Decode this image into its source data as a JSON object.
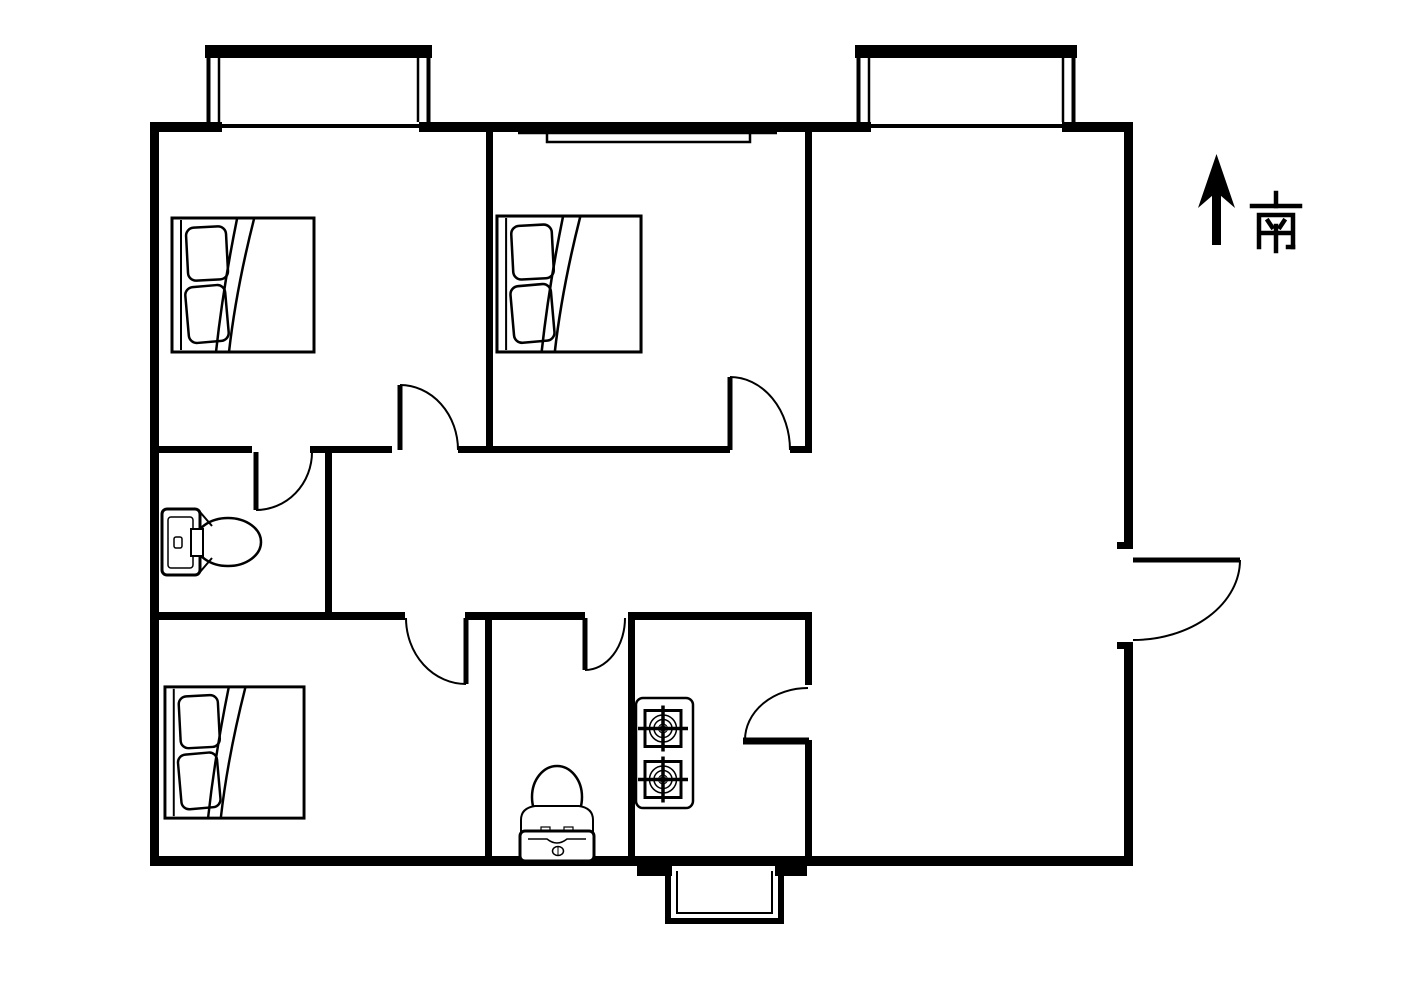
{
  "document": {
    "type": "residential apartment floor plan drawing",
    "background_color": "#ffffff",
    "line_color": "#000000"
  },
  "compass": {
    "label": "南",
    "meaning": "south",
    "arrow_points": "up"
  },
  "inventory": {
    "beds": 3,
    "toilets": 2,
    "gas_stove_burners": 2,
    "swing_doors": 7,
    "bay_windows": 2,
    "bottom_protrusion": 1,
    "interior_window": 1
  }
}
